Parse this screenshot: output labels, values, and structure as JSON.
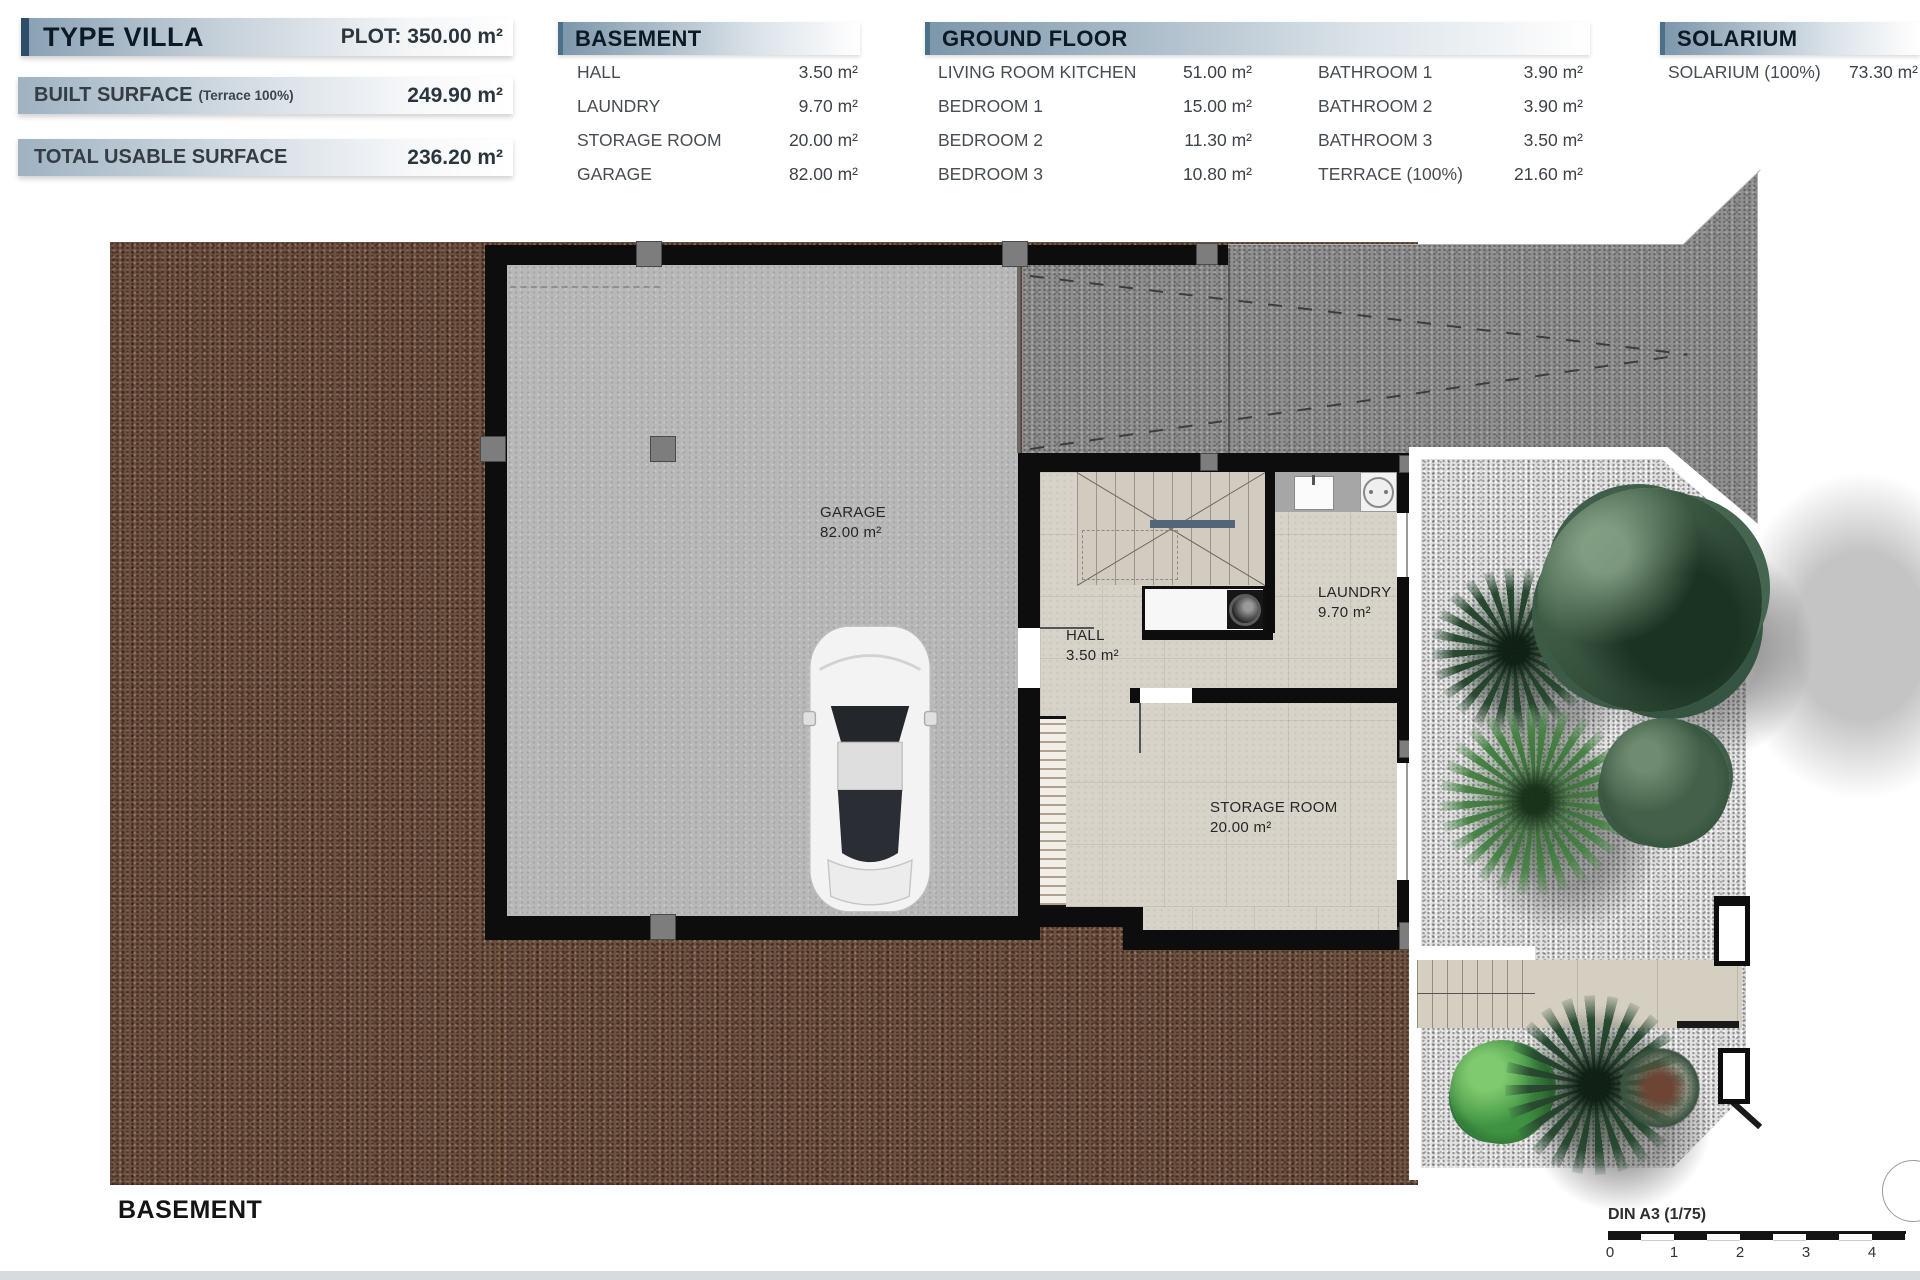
{
  "header": {
    "type_villa": {
      "title": "TYPE VILLA",
      "plot": "PLOT: 350.00 m²"
    },
    "built_surface": {
      "label": "BUILT SURFACE",
      "note": "(Terrace 100%)",
      "value": "249.90 m²"
    },
    "total_usable": {
      "label": "TOTAL USABLE SURFACE",
      "value": "236.20 m²"
    }
  },
  "tables": {
    "basement": {
      "title": "BASEMENT",
      "rows": [
        {
          "label": "HALL",
          "value": "3.50 m²"
        },
        {
          "label": "LAUNDRY",
          "value": "9.70 m²"
        },
        {
          "label": "STORAGE ROOM",
          "value": "20.00 m²"
        },
        {
          "label": "GARAGE",
          "value": "82.00 m²"
        }
      ]
    },
    "ground_floor": {
      "title": "GROUND FLOOR",
      "col1": [
        {
          "label": "LIVING ROOM KITCHEN",
          "value": "51.00 m²"
        },
        {
          "label": "BEDROOM 1",
          "value": "15.00 m²"
        },
        {
          "label": "BEDROOM 2",
          "value": "11.30 m²"
        },
        {
          "label": "BEDROOM 3",
          "value": "10.80 m²"
        }
      ],
      "col2": [
        {
          "label": "BATHROOM 1",
          "value": "3.90 m²"
        },
        {
          "label": "BATHROOM 2",
          "value": "3.90 m²"
        },
        {
          "label": "BATHROOM 3",
          "value": "3.50 m²"
        },
        {
          "label": "TERRACE (100%)",
          "value": "21.60 m²"
        }
      ]
    },
    "solarium": {
      "title": "SOLARIUM",
      "rows": [
        {
          "label": "SOLARIUM (100%)",
          "value": "73.30 m²"
        }
      ]
    }
  },
  "plan": {
    "rooms": [
      {
        "name": "GARAGE",
        "area": "82.00 m²"
      },
      {
        "name": "HALL",
        "area": "3.50 m²"
      },
      {
        "name": "LAUNDRY",
        "area": "9.70 m²"
      },
      {
        "name": "STORAGE ROOM",
        "area": "20.00 m²"
      }
    ],
    "floor_caption": "BASEMENT"
  },
  "scale_bar": {
    "label": "DIN A3 (1/75)",
    "ticks": [
      "0",
      "1",
      "2",
      "3",
      "4"
    ]
  },
  "colors": {
    "accent_navy": "#2e4d68",
    "header_text": "#0c1a26",
    "terrain_brown": "#6f5140",
    "ramp_gray": "#8f8f8f",
    "garage_gray": "#b8b8b8",
    "garden_gravel": "#e1e1e1"
  }
}
